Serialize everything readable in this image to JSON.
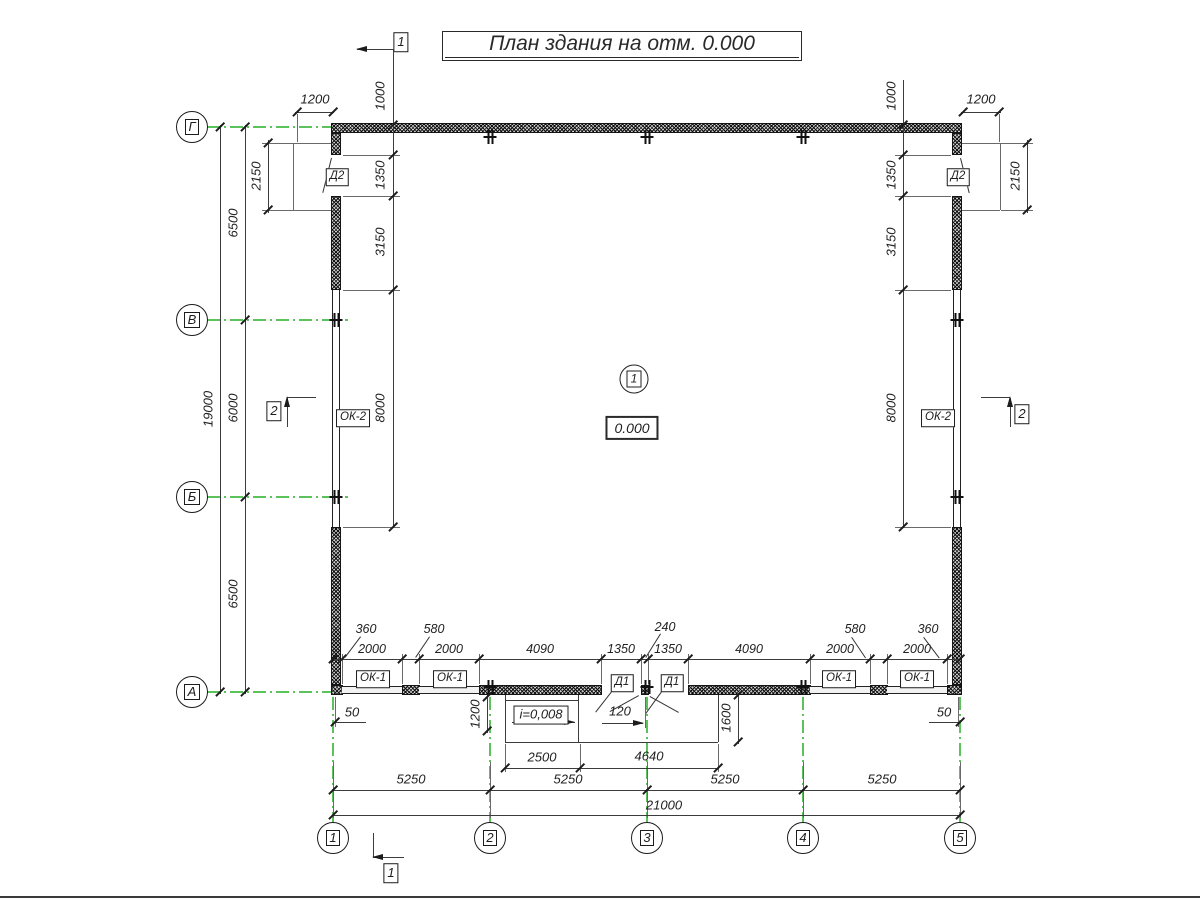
{
  "title": "План здания на отм. 0.000",
  "axes": {
    "rows": [
      "Г",
      "В",
      "Б",
      "А"
    ],
    "cols": [
      "1",
      "2",
      "3",
      "4",
      "5"
    ]
  },
  "sections": {
    "s1": "1",
    "s2": "2"
  },
  "room": {
    "number": "1",
    "elevation": "0.000"
  },
  "openings": {
    "d1": "Д1",
    "d2": "Д2",
    "ok1": "ОК-1",
    "ok2": "ОК-2"
  },
  "slope": "i=0,008",
  "dims": {
    "total_v": "19000",
    "total_h": "21000",
    "v_segments": [
      "6500",
      "6000",
      "6500"
    ],
    "h_segments": [
      "5250",
      "5250",
      "5250",
      "5250"
    ],
    "door2_width": "1200",
    "door2_height": "2150",
    "top_offset": "1000",
    "side_openings": [
      "1350",
      "3150",
      "8000"
    ],
    "bottom_small": {
      "k360": "360",
      "k580": "580",
      "k240": "240",
      "k2000": "2000",
      "k4090": "4090",
      "k1350": "1350"
    },
    "edge_gap": "50",
    "pier_half": "120",
    "ramp_depth": "1200",
    "ramp_width": "2500",
    "porch_width": "4640",
    "porch_depth": "1600"
  }
}
